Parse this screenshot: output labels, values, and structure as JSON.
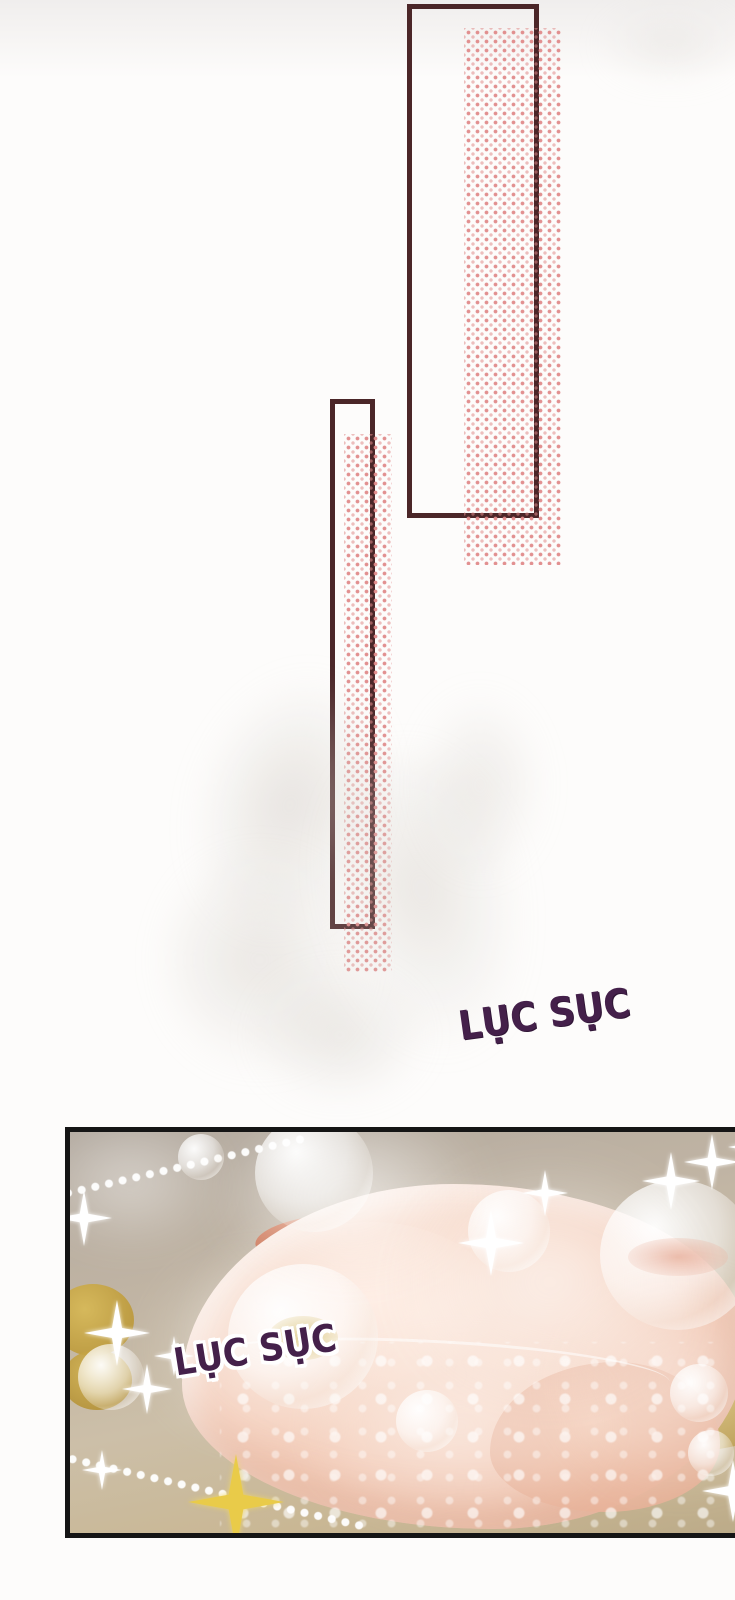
{
  "page": {
    "type": "comic-page",
    "background": "#fdfcfb"
  },
  "colors": {
    "frame_border": "#4b2628",
    "halftone_dot": "#e08a8a",
    "sfx_text": "#44204a",
    "sfx_outline": "#ffffff",
    "food_panel_border": "#151515",
    "broth_base": "#c3b6a2",
    "chicken_skin": "#f5d5c4",
    "sparkle_white": "#ffffff",
    "sparkle_gold": "#e9cb49",
    "smoke": "#d6d2cc"
  },
  "sfx": {
    "top": {
      "text": "LỤC SỤC"
    },
    "panel": {
      "text": "LỤC SỤC"
    }
  }
}
